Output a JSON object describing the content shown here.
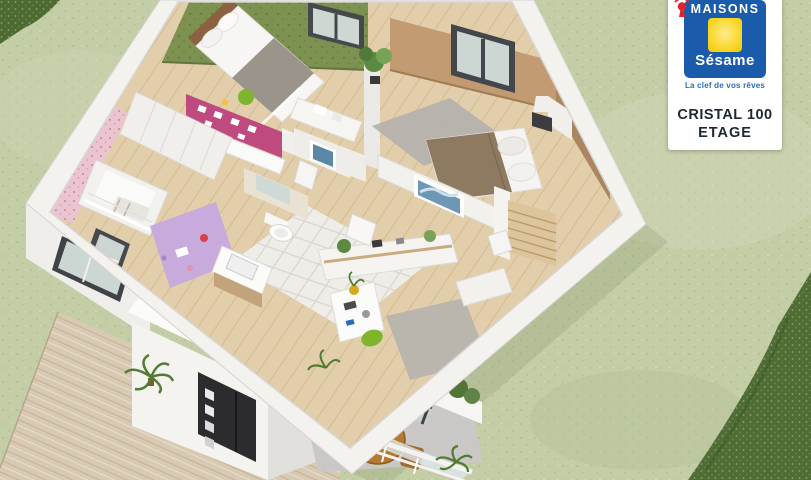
{
  "branding": {
    "brand_top": "MAISONS",
    "brand_name": "Sésame",
    "tagline": "La clef de vos rêves",
    "logo_icon": "keyhole-house-icon",
    "colors": {
      "blue": "#1a5cab",
      "yellow": "#f8d41c",
      "red": "#e02427"
    }
  },
  "title_card": {
    "model": "CRISTAL 100",
    "level": "ETAGE"
  },
  "scene": {
    "type": "3d-floor-plan-render",
    "level_shown": "upper floor",
    "rooms": [
      {
        "name": "bedroom-1",
        "accent_wall": "#7d9150",
        "furniture": [
          "bed",
          "desk",
          "green-chair",
          "wardrobes",
          "magenta-pinboard-wall"
        ]
      },
      {
        "name": "nursery",
        "accent_wall": "#ebc4d1",
        "furniture": [
          "crib",
          "purple-rug",
          "toys",
          "wardrobe",
          "window"
        ]
      },
      {
        "name": "bathroom",
        "floor": "white-tile",
        "furniture": [
          "vanity-sink",
          "mirror",
          "toilet"
        ]
      },
      {
        "name": "shower-room",
        "furniture": [
          "washbasin",
          "blue-picture"
        ]
      },
      {
        "name": "master-bedroom",
        "accent_wall": "#bd9a74",
        "furniture": [
          "double-bed",
          "grey-rug",
          "bedside-lamp",
          "plant",
          "blue-artwork",
          "window"
        ]
      },
      {
        "name": "landing-office",
        "furniture": [
          "desk",
          "green-chair",
          "sideboard-shelf",
          "grey-rug",
          "plants"
        ]
      },
      {
        "name": "staircase",
        "material": "wood"
      },
      {
        "name": "balcony",
        "furniture": [
          "round-wood-table",
          "two-chairs",
          "glass-railing",
          "planter",
          "sliding-door"
        ]
      }
    ],
    "exterior": [
      "lawn",
      "hedge-top-left",
      "hedge-bottom-right",
      "wood-deck",
      "palm-plants",
      "black-front-door",
      "white-facade"
    ],
    "palette": {
      "grass": "#c3cda6",
      "hedge": "#4d6a33",
      "deck": "#d8cab2",
      "walls": "#f3f2ef",
      "wood_floor": "#e2ceaa",
      "green_wall": "#7d9150",
      "pink_wall": "#ebc4d1",
      "tan_wall": "#bd9a74",
      "magenta_wall": "#bf4a7f",
      "purple_rug": "#c6a9de",
      "grey_rug": "#b4b1ac",
      "balcony_table": "#b5792f",
      "front_door": "#2c2c2e"
    }
  }
}
